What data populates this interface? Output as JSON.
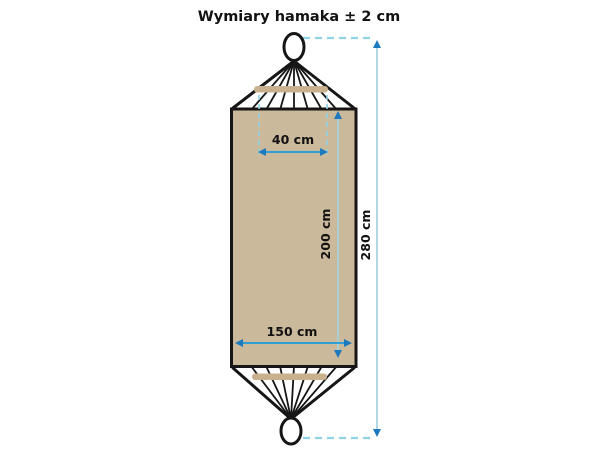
{
  "title": "Wymiary hamaka ± 2 cm",
  "diagram": {
    "subject": "hammock-dimensions",
    "dimensions": {
      "bar_width": {
        "label": "40 cm"
      },
      "fabric_width": {
        "label": "150 cm"
      },
      "fabric_length": {
        "label": "200 cm"
      },
      "total_length": {
        "label": "280 cm"
      }
    },
    "colors": {
      "fabric": "#cbb99b",
      "spreader_bar": "#c9b18d",
      "outline": "#161616",
      "dimension_arrow": "#2f9fd4",
      "dimension_arrowhead": "#1d79bd",
      "dimension_line_light": "#a5d2de",
      "dashed_guide": "#8fd2e8",
      "background": "#ffffff"
    }
  }
}
